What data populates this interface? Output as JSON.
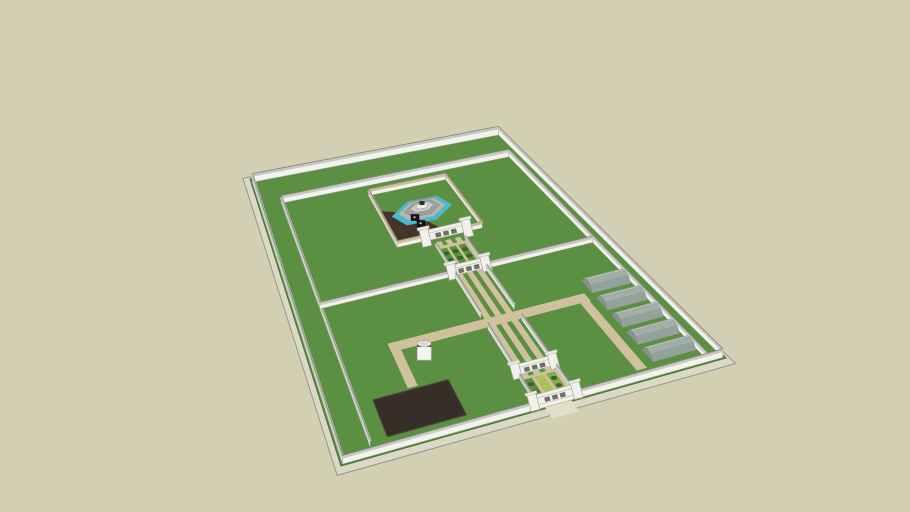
{
  "meta": {
    "subject": "3D model of a walled garden compound with central fountain courtyard, gated axial path, raised planting beds, five tunnel greenhouses, a dark ground plot and a water tank"
  },
  "colors": {
    "background": "#d3cfb3",
    "grass": "#5b9043",
    "grassEdge": "#47722f",
    "slab": "#dbd8c6",
    "slabEdge": "#96968a",
    "wallFace": "#f3f3ee",
    "wallTop": "#c6c9c2",
    "wallTopDark": "#85857b",
    "copingTan": "#cdbd9d",
    "path": "#cfc19d",
    "apron": "#e2dfc9",
    "plaza": "#453428",
    "plot": "#362e29",
    "plotEdge": "#5a4c3e",
    "water": "#3cc0da",
    "f1": "#b6b6b3",
    "f2": "#9e9e9b",
    "f3": "#c9c9c5",
    "f4": "#ededea",
    "black": "#161616",
    "bedGreen": "#5f8f3a",
    "bedBright": "#a9c155",
    "bedMid": "#84ad47",
    "bedDark": "#3a632c",
    "ghLight": "#b7c2bb",
    "ghBody": "#b2bdb6",
    "ghMid": "#a3aea7",
    "ghShade": "#95a29b",
    "ghEnd": "#87948c",
    "ghOutline": "#78847c",
    "gateFace": "#f1f1ec",
    "gateCap": "#ecece7",
    "gateShade": "#b9b9b0",
    "archDark": "#70706a",
    "cylBody": "#f4f4f1",
    "cylRim": "#2a2a27",
    "cylTop": "#e9e9e4"
  },
  "scene": {
    "corners": {
      "A": [
        250,
        179
      ],
      "B": [
        497,
        132
      ],
      "C": [
        726,
        358
      ],
      "D": [
        341,
        466
      ]
    },
    "objects": [
      {
        "type": "slab",
        "name": "base-slab",
        "scale": 1.035,
        "dy": 3,
        "fill": "slab",
        "stroke": "slabEdge"
      },
      {
        "type": "rect",
        "name": "lawn",
        "r": [
          0,
          0,
          1,
          1
        ],
        "fill": "grass",
        "stroke": "grassEdge",
        "sw": 1
      },
      {
        "type": "rect",
        "name": "corridor-path-west",
        "r": [
          0.524,
          0.345,
          0.542,
          0.992
        ],
        "fill": "path"
      },
      {
        "type": "rect",
        "name": "corridor-path-center",
        "r": [
          0.556,
          0.345,
          0.574,
          0.992
        ],
        "fill": "path"
      },
      {
        "type": "rect",
        "name": "corridor-path-east",
        "r": [
          0.588,
          0.345,
          0.606,
          0.992
        ],
        "fill": "path"
      },
      {
        "type": "rect",
        "name": "cross-path",
        "r": [
          0.235,
          0.645,
          0.82,
          0.676
        ],
        "fill": "path"
      },
      {
        "type": "rect",
        "name": "west-branch-path",
        "r": [
          0.235,
          0.645,
          0.263,
          0.808
        ],
        "fill": "path"
      },
      {
        "type": "rect",
        "name": "greenhouse-access-path",
        "r": [
          0.79,
          0.645,
          0.817,
          0.958
        ],
        "fill": "path"
      },
      {
        "type": "poly",
        "name": "courtyard-plaza",
        "pts": [
          [
            0.405,
            0.195
          ],
          [
            0.505,
            0.225
          ],
          [
            0.59,
            0.329
          ],
          [
            0.405,
            0.329
          ]
        ],
        "fill": "plaza"
      },
      {
        "type": "rect",
        "name": "dark-ground-plot",
        "r": [
          0.135,
          0.815,
          0.345,
          0.948
        ],
        "fill": "plot",
        "stroke": "plotEdge",
        "sw": 1
      },
      {
        "type": "rect",
        "name": "upper-bed-terrace",
        "r": [
          0.515,
          0.362,
          0.615,
          0.468
        ],
        "fill": "path"
      },
      {
        "type": "bed",
        "name": "upper-bed-1",
        "r": [
          0.5225,
          0.372,
          0.5455,
          0.459
        ],
        "fill": "bedGreen",
        "dots": "bedDark"
      },
      {
        "type": "bed",
        "name": "upper-bed-2",
        "r": [
          0.5535,
          0.372,
          0.5765,
          0.459
        ],
        "fill": "bedGreen",
        "dots": "bedDark"
      },
      {
        "type": "bed",
        "name": "upper-bed-3",
        "r": [
          0.5845,
          0.372,
          0.6075,
          0.459
        ],
        "fill": "bedGreen",
        "dots": "bedDark"
      },
      {
        "type": "rect",
        "name": "lower-bed-terrace",
        "r": [
          0.515,
          0.875,
          0.615,
          0.988
        ],
        "fill": "path"
      },
      {
        "type": "bed",
        "name": "lower-bed-1",
        "r": [
          0.5225,
          0.884,
          0.5455,
          0.98
        ],
        "fill": "bedGreen",
        "dots": "bedDark"
      },
      {
        "type": "bed",
        "name": "lower-bed-2",
        "r": [
          0.5535,
          0.884,
          0.5765,
          0.98
        ],
        "fill": "bedBright"
      },
      {
        "type": "bed",
        "name": "lower-bed-3",
        "r": [
          0.5845,
          0.884,
          0.6075,
          0.98
        ],
        "fill": "bedMid",
        "dots": "bedDark"
      },
      {
        "type": "wall",
        "name": "outer-wall-north",
        "a": [
          0.005,
          0.012
        ],
        "b": [
          0.995,
          0.012
        ],
        "h": 7
      },
      {
        "type": "wall",
        "name": "outer-wall-east",
        "a": [
          0.995,
          0.012
        ],
        "b": [
          0.995,
          0.995
        ],
        "h": 7
      },
      {
        "type": "wall",
        "name": "inner-wall-north",
        "a": [
          0.085,
          0.1
        ],
        "b": [
          0.958,
          0.1
        ],
        "h": 6
      },
      {
        "type": "wall",
        "name": "inner-wall-east",
        "a": [
          0.958,
          0.1
        ],
        "b": [
          0.958,
          0.99
        ],
        "h": 6
      },
      {
        "type": "wall",
        "name": "inner-wall-west",
        "a": [
          0.085,
          0.1
        ],
        "b": [
          0.085,
          0.965
        ],
        "h": 6
      },
      {
        "type": "wall",
        "name": "middle-wall-west",
        "a": [
          0.085,
          0.475
        ],
        "b": [
          0.512,
          0.475
        ],
        "h": 5
      },
      {
        "type": "wall",
        "name": "middle-wall-east",
        "a": [
          0.618,
          0.475
        ],
        "b": [
          0.958,
          0.475
        ],
        "h": 5
      },
      {
        "type": "wall",
        "name": "courtyard-wall-north",
        "a": [
          0.4,
          0.135
        ],
        "b": [
          0.69,
          0.135
        ],
        "h": 5,
        "top": "copingTan"
      },
      {
        "type": "wall",
        "name": "courtyard-wall-west",
        "a": [
          0.4,
          0.135
        ],
        "b": [
          0.4,
          0.332
        ],
        "h": 5,
        "top": "copingTan"
      },
      {
        "type": "wall",
        "name": "courtyard-wall-east",
        "a": [
          0.69,
          0.135
        ],
        "b": [
          0.69,
          0.332
        ],
        "h": 5,
        "top": "copingTan"
      },
      {
        "type": "wall",
        "name": "courtyard-wall-south-left",
        "a": [
          0.4,
          0.332
        ],
        "b": [
          0.508,
          0.332
        ],
        "h": 5,
        "top": "copingTan"
      },
      {
        "type": "wall",
        "name": "courtyard-wall-south-right",
        "a": [
          0.622,
          0.332
        ],
        "b": [
          0.69,
          0.332
        ],
        "h": 5,
        "top": "copingTan"
      },
      {
        "type": "fountain",
        "name": "octagonal-fountain",
        "at": [
          0.545,
          0.225
        ],
        "shear": -0.2,
        "rings": [
          {
            "rx": 30,
            "ry": 13.5,
            "fill": "water",
            "dy": 0
          },
          {
            "rx": 24,
            "ry": 10.8,
            "fill": "f1",
            "dy": -1
          },
          {
            "rx": 18,
            "ry": 8,
            "fill": "f2",
            "dy": -2
          },
          {
            "rx": 12,
            "ry": 5.2,
            "fill": "f3",
            "dy": -3.5
          },
          {
            "rx": 6.5,
            "ry": 3,
            "fill": "f4",
            "dy": -4.5
          }
        ],
        "boxes": [
          [
            -11,
            9
          ],
          [
            -5,
            15
          ]
        ]
      },
      {
        "type": "gate",
        "name": "courtyard-gate",
        "at": [
          0.565,
          0.345
        ],
        "w": 26,
        "h": 14
      },
      {
        "type": "wall",
        "name": "upper-bed-curb-west",
        "a": [
          0.515,
          0.362
        ],
        "b": [
          0.515,
          0.468
        ],
        "h": 3.5
      },
      {
        "type": "wall",
        "name": "upper-bed-curb-east",
        "a": [
          0.615,
          0.362
        ],
        "b": [
          0.615,
          0.468
        ],
        "h": 3.5
      },
      {
        "type": "gate",
        "name": "middle-gate",
        "at": [
          0.565,
          0.478
        ],
        "w": 22,
        "h": 12
      },
      {
        "type": "wall",
        "name": "corridor-wall-west-upper",
        "a": [
          0.515,
          0.482
        ],
        "b": [
          0.515,
          0.64
        ],
        "h": 5
      },
      {
        "type": "wall",
        "name": "corridor-wall-east-upper",
        "a": [
          0.615,
          0.482
        ],
        "b": [
          0.615,
          0.64
        ],
        "h": 5
      },
      {
        "type": "wall",
        "name": "corridor-wall-west-lower",
        "a": [
          0.515,
          0.682
        ],
        "b": [
          0.515,
          0.868
        ],
        "h": 5
      },
      {
        "type": "wall",
        "name": "corridor-wall-east-lower",
        "a": [
          0.615,
          0.682
        ],
        "b": [
          0.615,
          0.868
        ],
        "h": 5
      },
      {
        "type": "gate",
        "name": "lower-gate",
        "at": [
          0.565,
          0.868
        ],
        "w": 24,
        "h": 12
      },
      {
        "type": "wall",
        "name": "lower-bed-curb-west",
        "a": [
          0.515,
          0.878
        ],
        "b": [
          0.515,
          0.99
        ],
        "h": 4
      },
      {
        "type": "wall",
        "name": "lower-bed-curb-east",
        "a": [
          0.615,
          0.878
        ],
        "b": [
          0.615,
          0.99
        ],
        "h": 4
      },
      {
        "type": "tunnel",
        "name": "greenhouse-1",
        "u1": 0.84,
        "u2": 0.955,
        "vc": 0.625,
        "wv": 0.026,
        "lift": 7
      },
      {
        "type": "tunnel",
        "name": "greenhouse-2",
        "u1": 0.84,
        "u2": 0.955,
        "vc": 0.698,
        "wv": 0.026,
        "lift": 7
      },
      {
        "type": "tunnel",
        "name": "greenhouse-3",
        "u1": 0.84,
        "u2": 0.955,
        "vc": 0.771,
        "wv": 0.026,
        "lift": 7
      },
      {
        "type": "tunnel",
        "name": "greenhouse-4",
        "u1": 0.84,
        "u2": 0.955,
        "vc": 0.844,
        "wv": 0.026,
        "lift": 7
      },
      {
        "type": "tunnel",
        "name": "greenhouse-5",
        "u1": 0.84,
        "u2": 0.955,
        "vc": 0.917,
        "wv": 0.026,
        "lift": 7
      },
      {
        "type": "wall",
        "name": "outer-wall-west",
        "a": [
          0.005,
          0.012
        ],
        "b": [
          0.005,
          0.995
        ],
        "h": 7
      },
      {
        "type": "rect",
        "name": "entrance-apron",
        "r": [
          0.532,
          0.995,
          0.6,
          1.04
        ],
        "fill": "apron"
      },
      {
        "type": "wall",
        "name": "outer-wall-south",
        "a": [
          0.005,
          0.995
        ],
        "b": [
          0.995,
          0.995
        ],
        "h": 7
      },
      {
        "type": "gate",
        "name": "entrance-gate",
        "at": [
          0.565,
          0.99
        ],
        "w": 27,
        "h": 13
      },
      {
        "type": "cylinder",
        "name": "water-tank",
        "at": [
          0.31,
          0.73
        ],
        "r": 7,
        "h": 15
      }
    ]
  }
}
